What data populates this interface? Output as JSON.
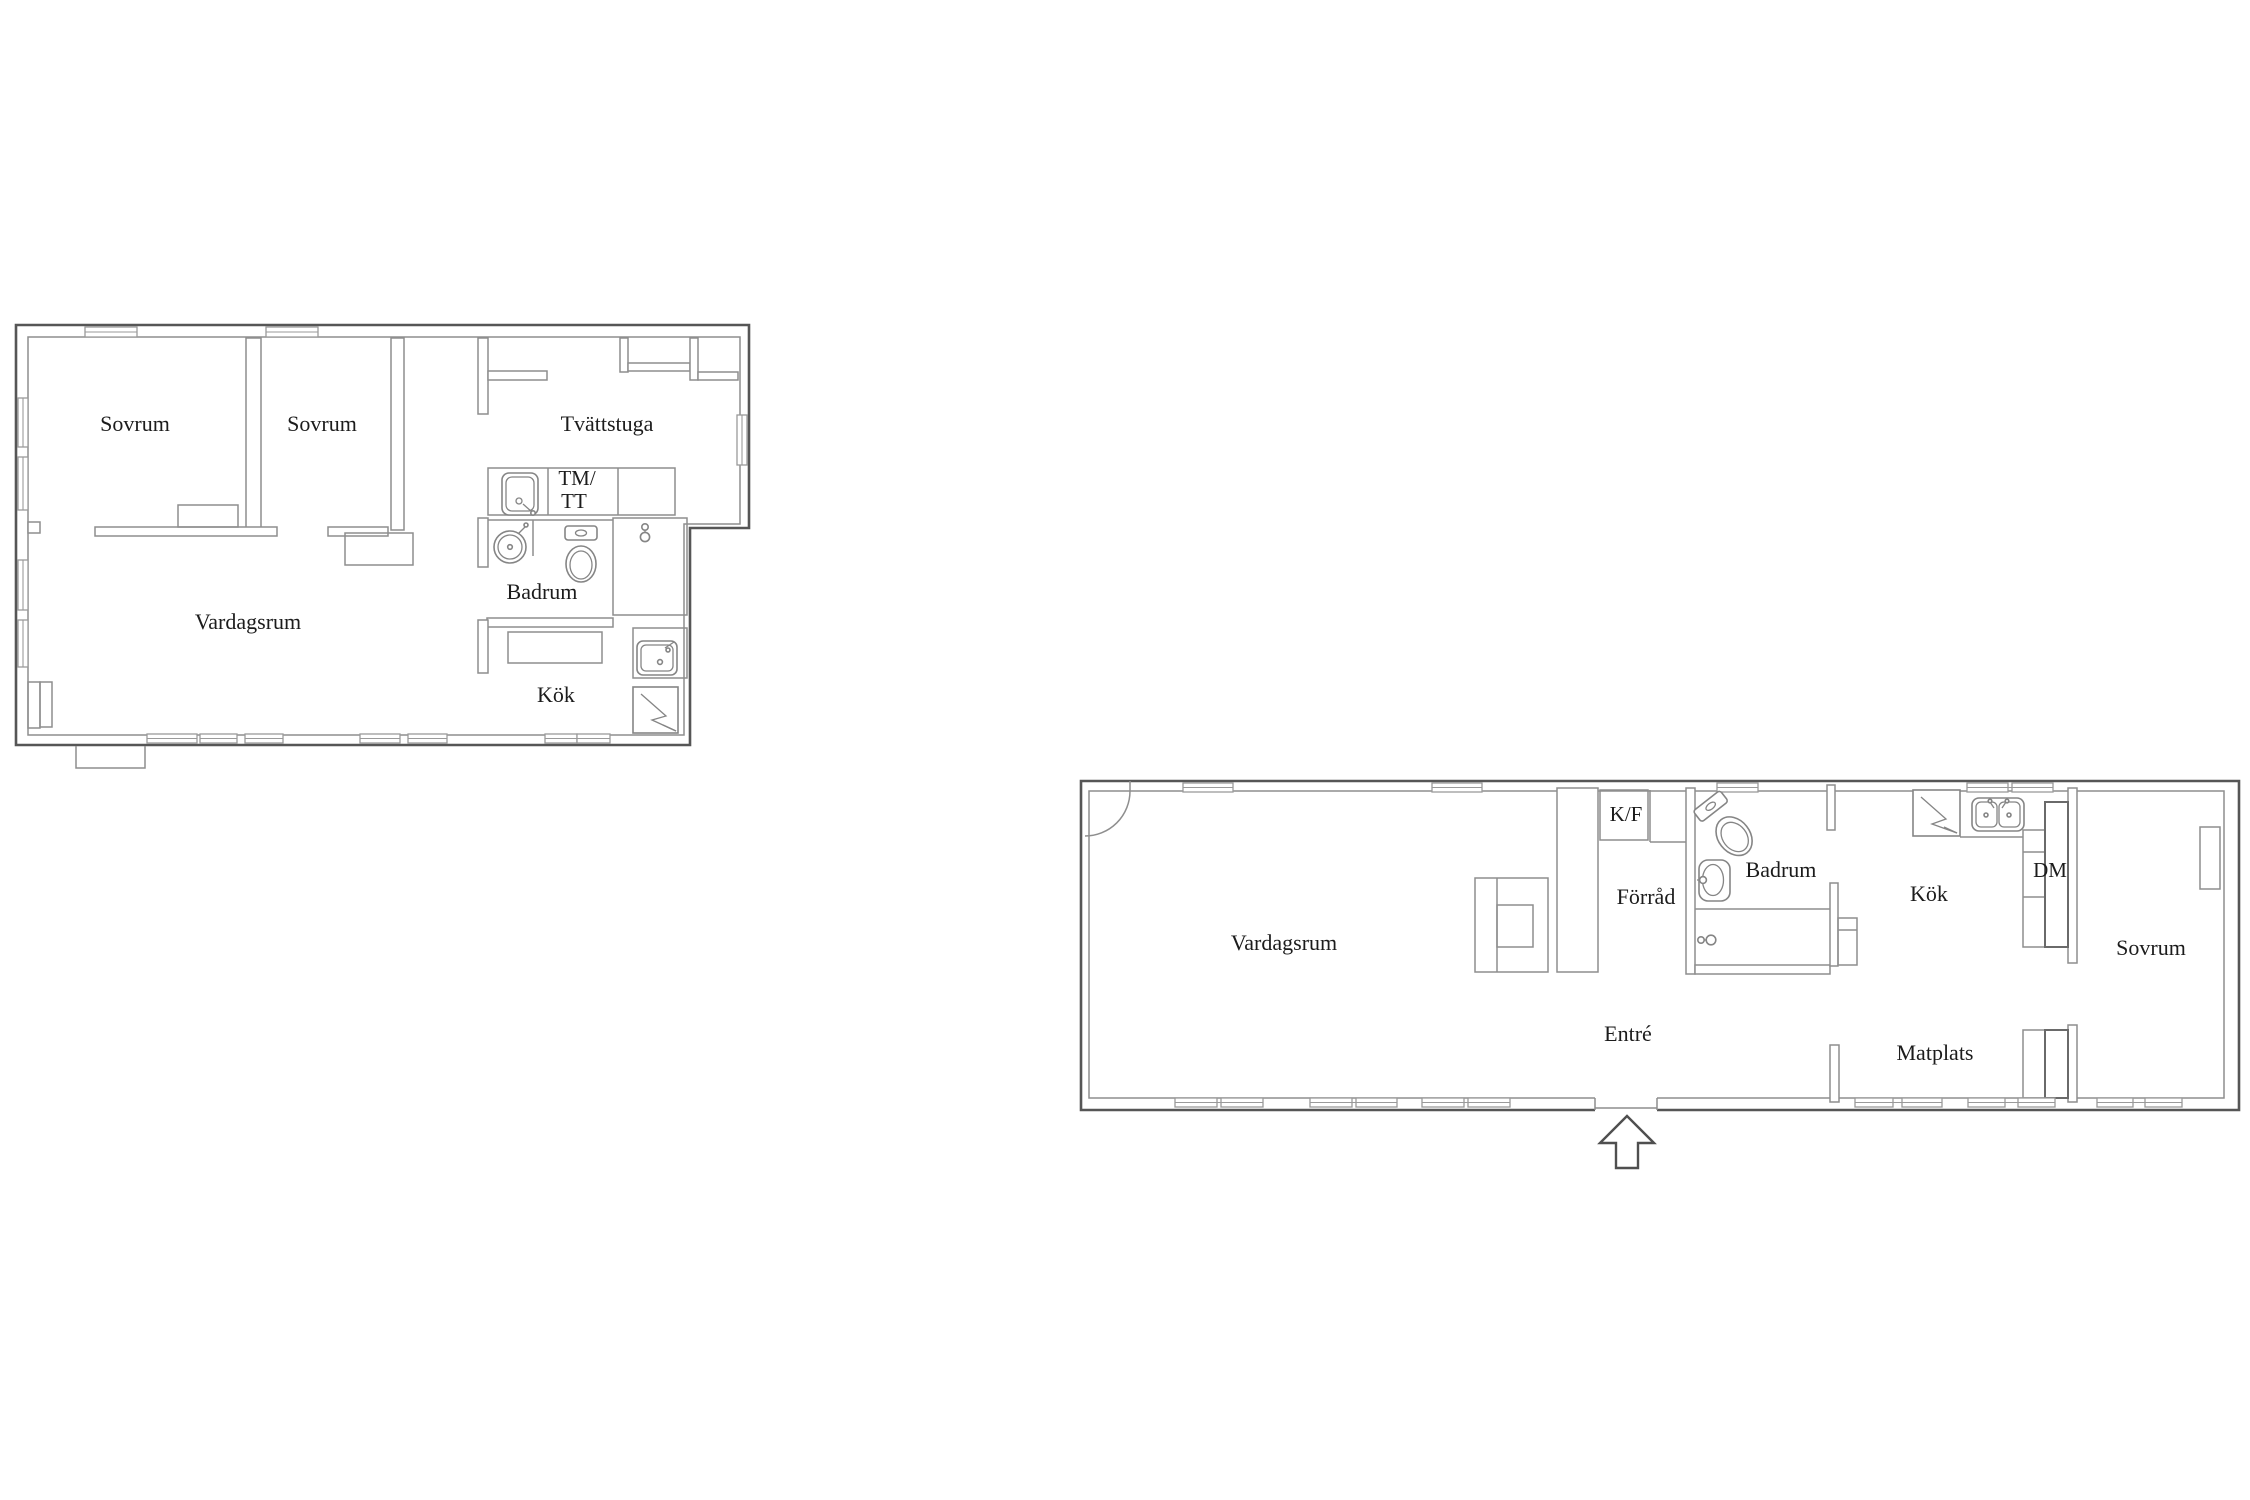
{
  "document": {
    "type": "real-estate floor plans",
    "background": "#ffffff",
    "plan_count": 2
  },
  "colors": {
    "outer_wall": "#565656",
    "inner_wall": "#8e8e8e",
    "fixture_line": "#858585",
    "text": "#1c1c1c"
  },
  "upper": {
    "sovrum1": "Sovrum",
    "sovrum2": "Sovrum",
    "tvattstuga": "Tvättstuga",
    "tm": "TM/",
    "tt": "TT",
    "badrum": "Badrum",
    "vardagsrum": "Vardagsrum",
    "kok": "Kök"
  },
  "lower": {
    "vardagsrum": "Vardagsrum",
    "kf": "K/F",
    "forrad": "Förråd",
    "badrum": "Badrum",
    "kok": "Kök",
    "dm": "DM",
    "sovrum": "Sovrum",
    "entre": "Entré",
    "matplats": "Matplats"
  },
  "icons": [
    "toilet-icon",
    "round-washbasin-icon",
    "oval-washbasin-icon",
    "laundry-sink-icon",
    "kitchen-sink-icon",
    "double-sink-icon",
    "stove-lightning-icon",
    "shower-mixer-icon",
    "door-swing-icon",
    "entrance-arrow-icon",
    "radiator-icon",
    "wardrobe-icon"
  ]
}
